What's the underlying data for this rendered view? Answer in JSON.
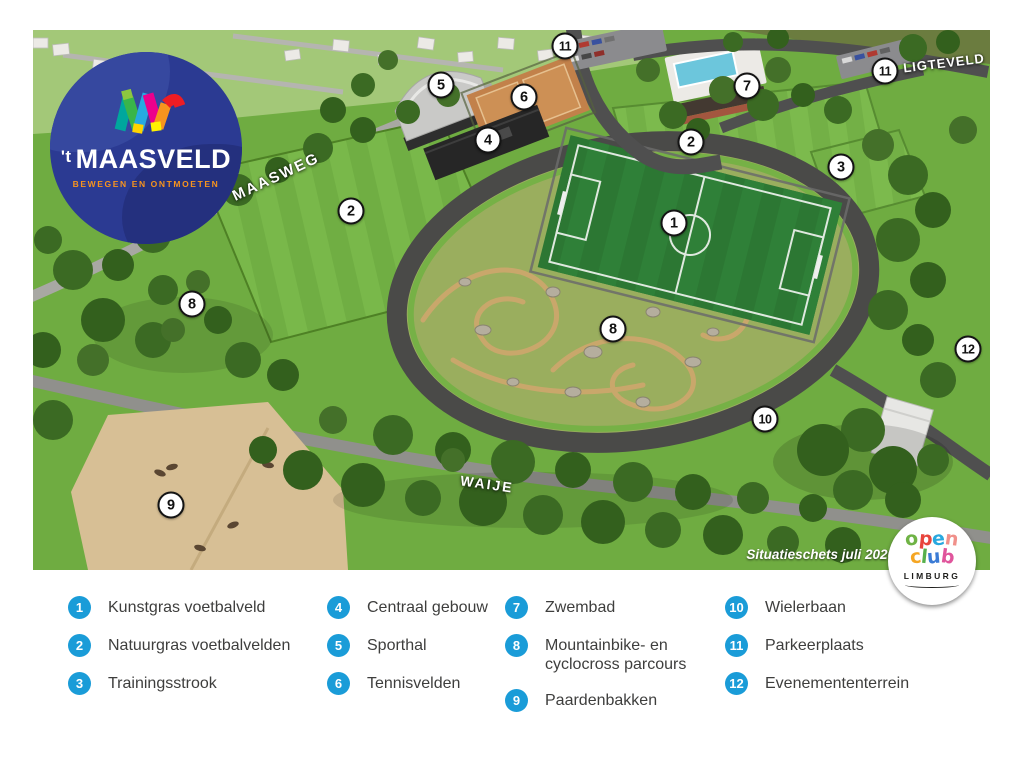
{
  "map": {
    "caption": "Situatieschets juli 2020",
    "markers": [
      {
        "num": "1",
        "x": 674,
        "y": 223
      },
      {
        "num": "2",
        "x": 351,
        "y": 211
      },
      {
        "num": "2",
        "x": 691,
        "y": 142
      },
      {
        "num": "3",
        "x": 841,
        "y": 167
      },
      {
        "num": "4",
        "x": 488,
        "y": 140
      },
      {
        "num": "5",
        "x": 441,
        "y": 85
      },
      {
        "num": "6",
        "x": 524,
        "y": 97
      },
      {
        "num": "7",
        "x": 747,
        "y": 86
      },
      {
        "num": "8",
        "x": 192,
        "y": 304
      },
      {
        "num": "8",
        "x": 613,
        "y": 329
      },
      {
        "num": "9",
        "x": 171,
        "y": 505
      },
      {
        "num": "10",
        "x": 765,
        "y": 419
      },
      {
        "num": "11",
        "x": 565,
        "y": 46
      },
      {
        "num": "11",
        "x": 885,
        "y": 71
      },
      {
        "num": "12",
        "x": 968,
        "y": 349
      }
    ],
    "road_labels": [
      {
        "text": "MAASWEG",
        "x": 276,
        "y": 177,
        "rot": -25,
        "size": 15,
        "spacing": 2
      },
      {
        "text": "WAIJE",
        "x": 487,
        "y": 484,
        "rot": 8,
        "size": 14,
        "spacing": 2
      },
      {
        "text": "LIGTEVELD",
        "x": 944,
        "y": 63,
        "rot": -7,
        "size": 13,
        "spacing": 1
      }
    ]
  },
  "logo": {
    "name_prefix": "'t",
    "name": "MAASVELD",
    "tagline": "BEWEGEN EN ONTMOETEN"
  },
  "openclub": {
    "line1": "open",
    "line2": "club",
    "region": "LIMBURG"
  },
  "legend": {
    "columns": [
      {
        "items": [
          {
            "num": "1",
            "label": "Kunstgras voetbalveld"
          },
          {
            "num": "2",
            "label": "Natuurgras voetbalvelden"
          },
          {
            "num": "3",
            "label": "Trainingsstrook"
          }
        ]
      },
      {
        "items": [
          {
            "num": "4",
            "label": "Centraal gebouw"
          },
          {
            "num": "5",
            "label": "Sporthal"
          },
          {
            "num": "6",
            "label": "Tennisvelden"
          }
        ]
      },
      {
        "items": [
          {
            "num": "7",
            "label": "Zwembad"
          },
          {
            "num": "8",
            "label": "Mountainbike- en",
            "label2": "cyclocross parcours"
          },
          {
            "num": "9",
            "label": "Paardenbakken"
          }
        ]
      },
      {
        "items": [
          {
            "num": "10",
            "label": "Wielerbaan"
          },
          {
            "num": "11",
            "label": "Parkeerplaats"
          },
          {
            "num": "12",
            "label": "Evenemententerrein"
          }
        ]
      }
    ]
  },
  "colors": {
    "legend_blue": "#1a9cd8",
    "logo_blue": "#2b3a92",
    "tagline_orange": "#f7941e"
  }
}
